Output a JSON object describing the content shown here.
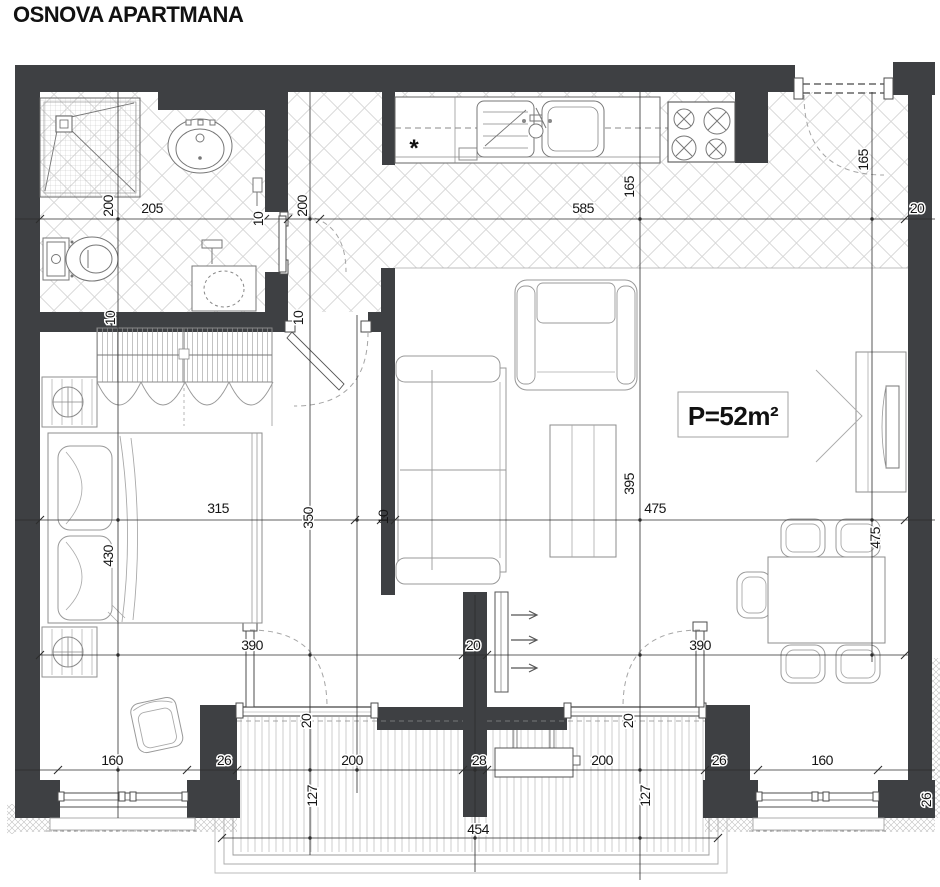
{
  "title": "OSNOVA APARTMANA",
  "plan": {
    "area_label": "P=52m²",
    "kitchen_asterisk": "*",
    "dims": {
      "d200_bath": "200",
      "d205": "205",
      "d10_a": "10",
      "d200_hall": "200",
      "d585": "585",
      "d165_kitchen": "165",
      "d165_entry": "165",
      "d20_tr": "20",
      "d10_c": "10",
      "d10_d": "10",
      "d315": "315",
      "d350": "350",
      "d10_b": "10",
      "d430": "430",
      "d395": "395",
      "d475_h": "475",
      "d475_v": "475",
      "d390_l": "390",
      "d20_mid": "20",
      "d390_r": "390",
      "d20_sill_l": "20",
      "d20_sill_r": "20",
      "d160_l": "160",
      "d26_l": "26",
      "d200_bl": "200",
      "d28": "28",
      "d200_br": "200",
      "d26_r": "26",
      "d160_r": "160",
      "d127_l": "127",
      "d127_r": "127",
      "d454": "454",
      "d26_side": "26"
    }
  }
}
